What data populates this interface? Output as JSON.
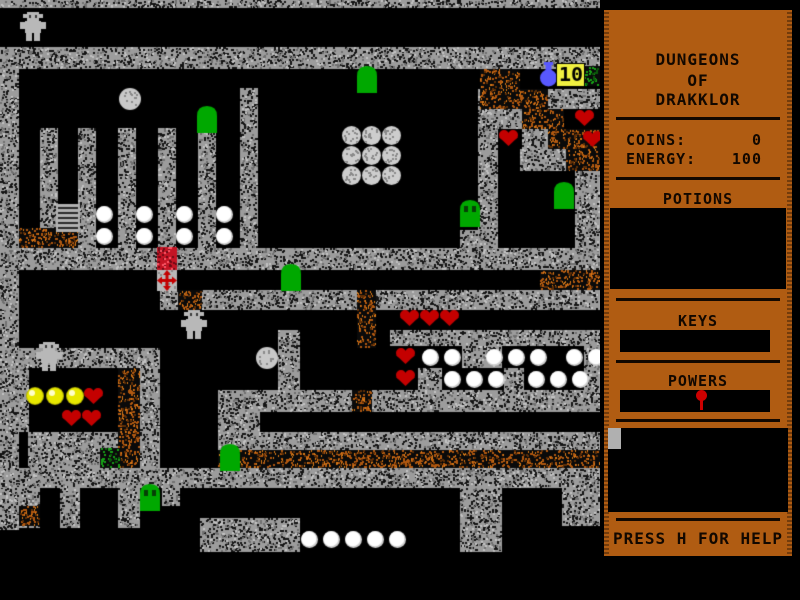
{
  "game": {
    "title_lines": [
      "DUNGEONS",
      "OF",
      "DRAKKLOR"
    ],
    "stats": {
      "coins_label": "COINS:",
      "coins_value": "0",
      "energy_label": "ENERGY:",
      "energy_value": "100"
    },
    "sections": {
      "potions": "POTIONS",
      "keys": "KEYS",
      "powers": "POWERS"
    },
    "help_text": "PRESS H FOR HELP",
    "hud": {
      "potion_count": "10"
    }
  },
  "colors": {
    "panel": "#b05c12",
    "panel_text": "#120800",
    "box": "#000000",
    "stone": "#9c9c9c",
    "stone_fleck_dark": "#141414",
    "stone_fleck_mid": "#707070",
    "stone_fleck_light": "#c2c2c2",
    "dirt_fleck": "#b05810",
    "dirt_fleck_bright": "#d97a18",
    "dirt_fleck_dark": "#5e2e06",
    "moss_fleck": "#17a017",
    "moss_fleck_dark": "#0a5a0a",
    "heart": "#c40000",
    "orb": "#ffffff",
    "coin": "#e8e800",
    "coin_hi": "#ffffcc",
    "slime": "#00a800",
    "slime_eye": "#063f06",
    "robot": "#b8b8b8",
    "ball": "#c8c8c8",
    "boulder": "#cdcdcd",
    "rock_fleck": "#8a8a8a",
    "ladder": "#b0b0b0",
    "ladder_rung": "#2a2a2a",
    "brick": "#c41424",
    "brick_dark": "#6e0a14",
    "brick_light": "#ff5868",
    "compass_bg": "#b8b8b8",
    "compass_cross": "#c40000",
    "potion": "#5858ff",
    "label_bg": "#f0f040",
    "label_text": "#000000",
    "cursor": "#b0b0b0",
    "pin": "#cc0000"
  },
  "map": {
    "width": 600,
    "height": 556,
    "background": "#000000",
    "walls": [
      [
        "s",
        0,
        0,
        600,
        8
      ],
      [
        "s",
        0,
        47,
        600,
        22
      ],
      [
        "s",
        0,
        69,
        19,
        461
      ],
      [
        "s",
        40,
        128,
        18,
        120
      ],
      [
        "s",
        78,
        128,
        18,
        120
      ],
      [
        "s",
        118,
        128,
        18,
        120
      ],
      [
        "s",
        158,
        128,
        18,
        120
      ],
      [
        "s",
        198,
        131,
        18,
        117
      ],
      [
        "s",
        240,
        88,
        18,
        160
      ],
      [
        "d",
        19,
        228,
        59,
        20
      ],
      [
        "s",
        478,
        89,
        20,
        160
      ],
      [
        "s",
        460,
        230,
        18,
        19
      ],
      [
        "d",
        480,
        69,
        40,
        40
      ],
      [
        "d",
        498,
        89,
        50,
        20
      ],
      [
        "s",
        548,
        89,
        52,
        20
      ],
      [
        "s",
        498,
        109,
        24,
        20
      ],
      [
        "d",
        522,
        109,
        42,
        20
      ],
      [
        "d",
        548,
        129,
        52,
        20
      ],
      [
        "s",
        522,
        129,
        26,
        20
      ],
      [
        "s",
        520,
        149,
        46,
        22
      ],
      [
        "d",
        566,
        149,
        34,
        22
      ],
      [
        "s",
        575,
        171,
        25,
        78
      ],
      [
        "m",
        584,
        66,
        16,
        20
      ],
      [
        "s",
        0,
        248,
        600,
        22
      ],
      [
        "d",
        540,
        270,
        60,
        20
      ],
      [
        "s",
        160,
        290,
        440,
        20
      ],
      [
        "d",
        178,
        290,
        24,
        20
      ],
      [
        "d",
        357,
        290,
        19,
        58
      ],
      [
        "s",
        278,
        330,
        22,
        62
      ],
      [
        "s",
        390,
        330,
        210,
        16
      ],
      [
        "s",
        462,
        346,
        40,
        22
      ],
      [
        "s",
        584,
        346,
        16,
        22
      ],
      [
        "s",
        418,
        368,
        24,
        22
      ],
      [
        "s",
        504,
        368,
        20,
        22
      ],
      [
        "s",
        584,
        368,
        16,
        22
      ],
      [
        "s",
        19,
        348,
        141,
        20
      ],
      [
        "s",
        19,
        368,
        10,
        64
      ],
      [
        "d",
        118,
        368,
        22,
        100
      ],
      [
        "s",
        140,
        368,
        20,
        100
      ],
      [
        "s",
        28,
        432,
        90,
        36
      ],
      [
        "m",
        100,
        448,
        20,
        20
      ],
      [
        "s",
        218,
        390,
        382,
        22
      ],
      [
        "d",
        352,
        390,
        20,
        22
      ],
      [
        "s",
        218,
        412,
        42,
        20
      ],
      [
        "s",
        218,
        432,
        382,
        18
      ],
      [
        "d",
        218,
        450,
        382,
        18
      ],
      [
        "s",
        0,
        468,
        600,
        20
      ],
      [
        "s",
        19,
        488,
        21,
        40
      ],
      [
        "d",
        19,
        506,
        21,
        20
      ],
      [
        "s",
        60,
        488,
        20,
        40
      ],
      [
        "s",
        118,
        488,
        22,
        40
      ],
      [
        "s",
        162,
        488,
        18,
        18
      ],
      [
        "s",
        200,
        518,
        100,
        34
      ],
      [
        "s",
        460,
        488,
        42,
        64
      ],
      [
        "s",
        562,
        488,
        38,
        38
      ]
    ],
    "entities": [
      [
        "robot",
        20,
        12
      ],
      [
        "robot",
        36,
        342
      ],
      [
        "robot",
        181,
        310
      ],
      [
        "ball",
        119,
        88
      ],
      [
        "ball",
        256,
        347
      ],
      [
        "boulder",
        342,
        126
      ],
      [
        "boulder",
        362,
        126
      ],
      [
        "boulder",
        382,
        126
      ],
      [
        "boulder",
        342,
        146
      ],
      [
        "boulder",
        362,
        146
      ],
      [
        "boulder",
        382,
        146
      ],
      [
        "boulder",
        342,
        166
      ],
      [
        "boulder",
        362,
        166
      ],
      [
        "boulder",
        382,
        166
      ],
      [
        "slime",
        197,
        106
      ],
      [
        "slime",
        357,
        66
      ],
      [
        "slime",
        281,
        264
      ],
      [
        "slime",
        554,
        182
      ],
      [
        "slime",
        220,
        444
      ],
      [
        "slime_eyes",
        460,
        200
      ],
      [
        "slime_eyes",
        140,
        484
      ],
      [
        "ladder",
        56,
        204
      ],
      [
        "orb",
        96,
        206
      ],
      [
        "orb",
        96,
        228
      ],
      [
        "orb",
        136,
        206
      ],
      [
        "orb",
        136,
        228
      ],
      [
        "orb",
        176,
        206
      ],
      [
        "orb",
        176,
        228
      ],
      [
        "orb",
        216,
        206
      ],
      [
        "orb",
        216,
        228
      ],
      [
        "brick",
        157,
        247
      ],
      [
        "compass",
        157,
        270
      ],
      [
        "coin",
        26,
        387
      ],
      [
        "coin",
        46,
        387
      ],
      [
        "coin",
        66,
        387
      ],
      [
        "heart",
        84,
        387
      ],
      [
        "heart",
        62,
        409
      ],
      [
        "heart",
        82,
        409
      ],
      [
        "heart",
        400,
        309
      ],
      [
        "heart",
        420,
        309
      ],
      [
        "heart",
        440,
        309
      ],
      [
        "heart",
        396,
        347
      ],
      [
        "heart",
        396,
        369
      ],
      [
        "heart",
        575,
        109
      ],
      [
        "heart",
        583,
        130
      ],
      [
        "heart",
        499,
        129
      ],
      [
        "orb",
        422,
        349
      ],
      [
        "orb",
        444,
        349
      ],
      [
        "orb",
        486,
        349
      ],
      [
        "orb",
        508,
        349
      ],
      [
        "orb",
        530,
        349
      ],
      [
        "orb",
        566,
        349
      ],
      [
        "orb",
        588,
        349
      ],
      [
        "orb",
        444,
        371
      ],
      [
        "orb",
        466,
        371
      ],
      [
        "orb",
        488,
        371
      ],
      [
        "orb",
        528,
        371
      ],
      [
        "orb",
        550,
        371
      ],
      [
        "orb",
        572,
        371
      ],
      [
        "orb",
        301,
        531
      ],
      [
        "orb",
        323,
        531
      ],
      [
        "orb",
        345,
        531
      ],
      [
        "orb",
        367,
        531
      ],
      [
        "orb",
        389,
        531
      ],
      [
        "potion",
        540,
        62
      ],
      [
        "label10",
        557,
        64
      ]
    ]
  }
}
